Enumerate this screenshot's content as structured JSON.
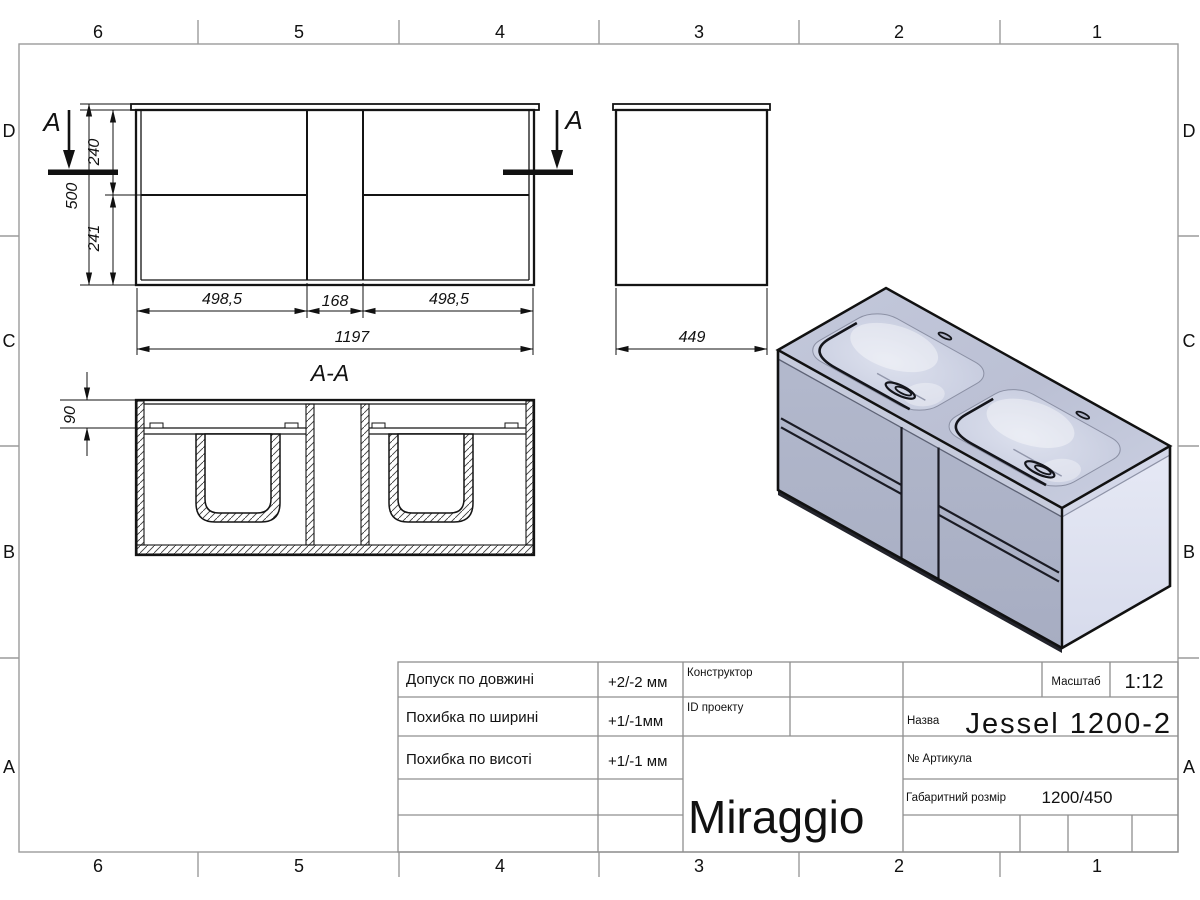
{
  "drawing": {
    "grid": {
      "cols": [
        "6",
        "5",
        "4",
        "3",
        "2",
        "1"
      ],
      "rows": [
        "D",
        "C",
        "B",
        "A"
      ]
    },
    "front_view": {
      "section_marker": "A",
      "dim_height_total": "500",
      "dim_height_top": "240",
      "dim_height_bottom": "241",
      "dim_width_left": "498,5",
      "dim_width_center": "168",
      "dim_width_right": "498,5",
      "dim_width_total": "1197"
    },
    "side_view": {
      "dim_depth": "449"
    },
    "section_view": {
      "title": "A-A",
      "dim_counter_height": "90"
    },
    "title_block": {
      "tolerances": [
        {
          "label": "Допуск по довжині",
          "value": "+2/-2 мм"
        },
        {
          "label": "Похибка по ширині",
          "value": "+1/-1мм"
        },
        {
          "label": "Похибка по висоті",
          "value": "+1/-1 мм"
        }
      ],
      "designer_label": "Конструктор",
      "project_id_label": "ID проекту",
      "brand": "Miraggio",
      "scale_label": "Масштаб",
      "scale_value": "1:12",
      "name_label": "Назва",
      "name_value": "Jessel 1200-2",
      "article_label": "№  Артикула",
      "size_label": "Габаритний розмір",
      "size_value": "1200/450"
    },
    "colors": {
      "line": "#141414",
      "frame": "#9b9b9b",
      "iso_top": "#bfc4d8",
      "iso_front": "#aeb4c9",
      "iso_side": "#e2e5f2",
      "basin": "#cdd2e3"
    }
  }
}
